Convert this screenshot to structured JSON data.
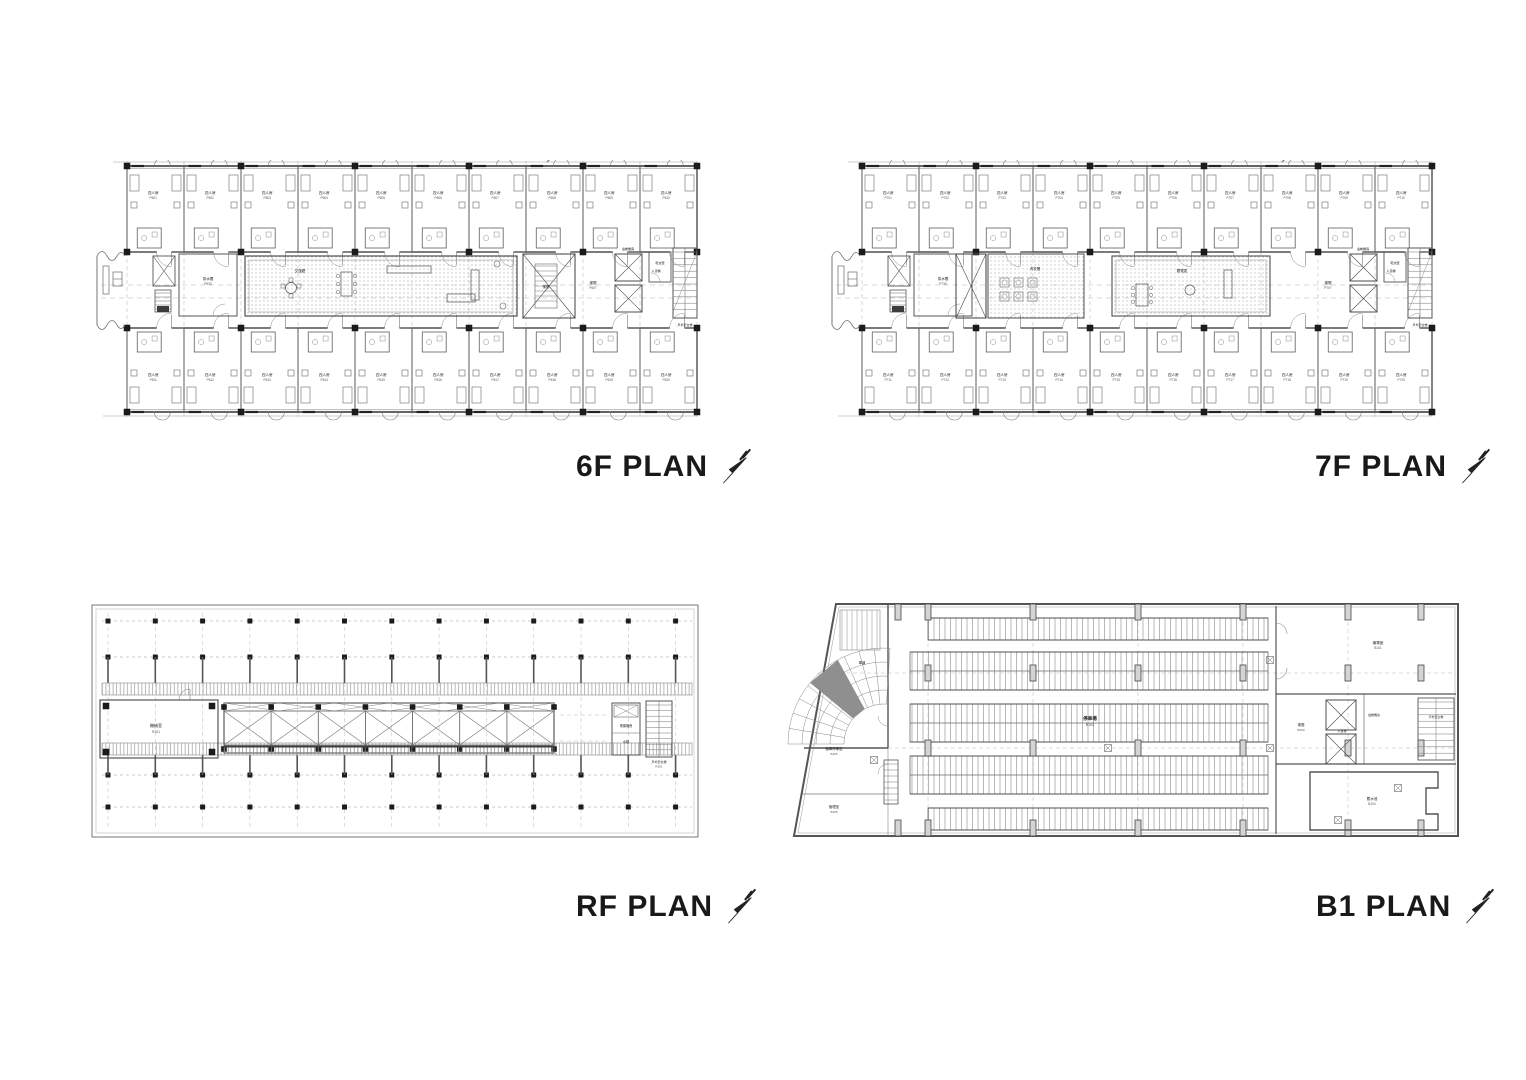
{
  "page": {
    "background": "#ffffff",
    "line_color": "#555555",
    "title_color": "#191919"
  },
  "plans": [
    {
      "id": "6f",
      "title": "6F PLAN",
      "north_mark": "N",
      "labels": {
        "typical_room": "四人房",
        "room_code_prefix": "P6",
        "stair": "梯間",
        "stair_code": "P607",
        "common_room": "交誼廳",
        "pantry": "茶水間",
        "service_lift": "人貨梯",
        "lift_machine": "電梯機房",
        "drying_room": "乾衣室",
        "outdoor_stair": "戶外安全梯"
      }
    },
    {
      "id": "7f",
      "title": "7F PLAN",
      "north_mark": "N",
      "labels": {
        "typical_room": "四人房",
        "room_code_prefix": "P7",
        "stair": "梯間",
        "stair_code": "P707",
        "laundry": "洗衣間",
        "reading": "閱覽區",
        "pantry": "茶水間",
        "service_lift": "人貨梯",
        "lift_machine": "電梯機房",
        "drying_room": "乾衣室",
        "outdoor_stair": "戶外安全梯"
      }
    },
    {
      "id": "rf",
      "title": "RF PLAN",
      "north_mark": "N",
      "labels": {
        "machine_room": "機械室",
        "machine_code": "R101",
        "lift_machine": "電梯機房",
        "water_tank": "水箱",
        "outdoor_stair": "戶外安全梯",
        "outdoor_stair_code": "R201"
      }
    },
    {
      "id": "b1",
      "title": "B1 PLAN",
      "north_mark": "N",
      "labels": {
        "parking": "停車場",
        "parking_code": "B102",
        "ramp": "車道",
        "moto_parking": "機車停車區",
        "manager": "管理室",
        "mep_room": "機電室",
        "stair": "梯間",
        "service_lift": "人貨梯",
        "lift_machine": "電梯機房",
        "outdoor_stair": "戶外安全梯",
        "water_tank": "蓄水池"
      }
    }
  ]
}
